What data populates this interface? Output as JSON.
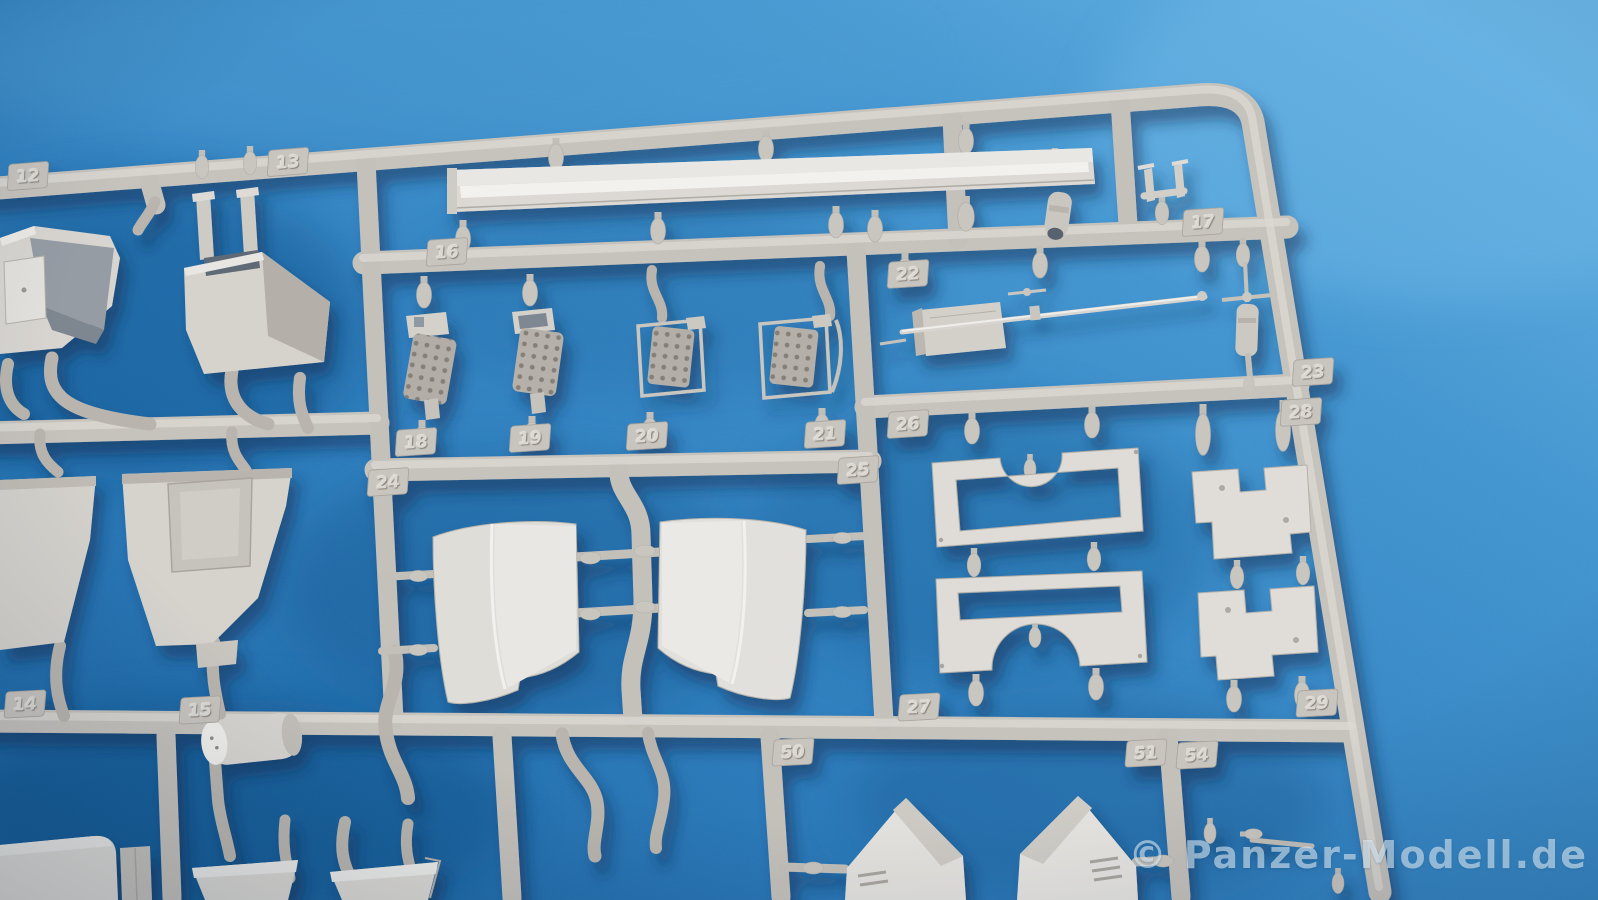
{
  "scene": {
    "subject": "Light grey injection-moulded model kit sprue photographed on a blue textured surface",
    "plastic_color": "#c9c5bf",
    "background_color": "#2e82c4"
  },
  "sprue": {
    "part_tags": [
      {
        "label": "12"
      },
      {
        "label": "13"
      },
      {
        "label": "14"
      },
      {
        "label": "15"
      },
      {
        "label": "16"
      },
      {
        "label": "17"
      },
      {
        "label": "18"
      },
      {
        "label": "19"
      },
      {
        "label": "20"
      },
      {
        "label": "21"
      },
      {
        "label": "22"
      },
      {
        "label": "23"
      },
      {
        "label": "24"
      },
      {
        "label": "25"
      },
      {
        "label": "26"
      },
      {
        "label": "27"
      },
      {
        "label": "28"
      },
      {
        "label": "29"
      },
      {
        "label": "50"
      },
      {
        "label": "51"
      },
      {
        "label": "54"
      }
    ]
  },
  "watermark": {
    "text": "© Panzer-Modell.de"
  }
}
